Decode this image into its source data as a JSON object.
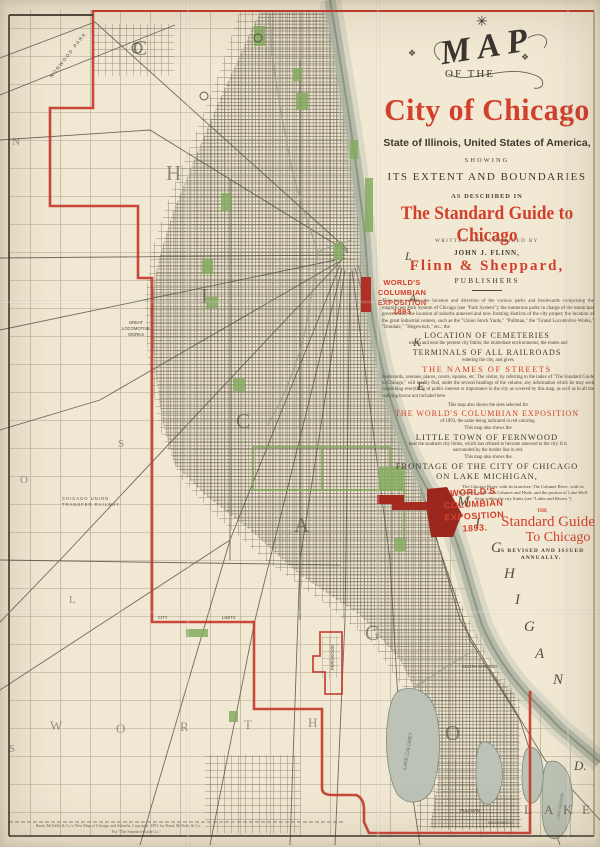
{
  "colors": {
    "paper": "#f1e8d3",
    "boundary_red": "#c5392b",
    "title_red": "#d2402c",
    "expo_red": "#b03026",
    "expo_dark_red": "#9b281f",
    "park_green": "#85ab60",
    "lake_shade": "#b2b9a8",
    "ink": "#433d31"
  },
  "title_block": {
    "star": "✳",
    "ornament_left": "❖",
    "ornament_right": "❖",
    "map_word": "MAP",
    "of_the": "OF THE",
    "city_title": "City of Chicago",
    "state_line": "State of Illinois, United States of America,",
    "showing": "SHOWING",
    "extent": "ITS EXTENT AND BOUNDARIES",
    "as_described": "AS DESCRIBED IN",
    "guide_title": "The Standard Guide to Chicago",
    "written_by": "WRITTEN AND COMPILED BY",
    "author": "JOHN J. FLINN,",
    "publisher": "Flinn & Sheppard,",
    "publishers_label": "PUBLISHERS",
    "para_intro": "This map exhibits the location and direction of the various parks and boulevards comprising the magnificent Park System of Chicago (see \"Park System\"); the numerous parks in charge of the municipal government; the location of suburbs annexed and now forming districts of the city proper; the location of the great industrial centers, such as the \"Union Stock Yards,\" \"Pullman,\" the \"Grand Locomotive Works,\" \"Irondale,\" \"Hegewisch,\" etc.; the",
    "cemeteries": "LOCATION OF CEMETERIES",
    "para_cemeteries": "within and near the present city limits; the immediate environments; the routes and",
    "terminals": "TERMINALS OF ALL RAILROADS",
    "para_terminals": "entering the city, and gives",
    "streets": "THE NAMES OF STREETS",
    "para_streets": "boulevards, avenues, places, courts, squares, etc.  The visitor, by referring to the index of \"The Standard Guide to Chicago,\" will readily find, under the several headings of the volume, any information which he may seek concerning everything of public interest or importance in the city as covered by this map, as well as in all the outlying towns not included here.",
    "para_sites": "This map also shows the sites selected for",
    "expo_heading": "THE WORLD'S COLUMBIAN EXPOSITION",
    "para_expo": "of 1893, the same being indicated in red coloring.",
    "also_shows_1": "This map also shows the",
    "fernwood": "LITTLE TOWN OF FERNWOOD",
    "para_fernwood": "near the southern city limits, which has refused to become annexed to the city.  It is surrounded by the border line in red.",
    "also_shows_2": "This map also shows the",
    "frontage_1": "FRONTAGE OF THE CITY OF CHICAGO",
    "frontage_2": "ON LAKE MICHIGAN,",
    "para_frontage": "The Chicago River, with its branches; The Calumet River, with its branches, and Lakes Calumet and Hyde, and the portion of Lake Wolf lying within the city limits (see \"Lakes and Rivers.\")",
    "the_word": "THE",
    "standard_guide_1": "Standard Guide",
    "standard_guide_2": "To Chicago",
    "annual_1": "IS REVISED AND ISSUED",
    "annual_2": "ANNUALLY."
  },
  "map_labels": {
    "expo_downtown": "WORLD'S\nCOLUMBIAN\nEXPOSITION\n1893",
    "expo_south": "WORLD'S\nCOLUMBIAN\nEXPOSITION\n1893.",
    "norwood_park": "NORWOOD PARK",
    "locomotive_works": "GREAT\nLOCOMOTIVE\nWORKS",
    "transfer_railway": "CHICAGO UNION\nTRANSFER RAILWAY",
    "city_limits_1": "CITY",
    "city_limits_2": "LIMITS",
    "pullman": "PULLMAN",
    "hegewisch": "HEGEWISCH",
    "south_chicago": "SOUTH CHICAGO",
    "fernwood_vertical": "FERNWOOD",
    "lake_calumet": "LAKE CALUMET",
    "lake_george": "LAKE GEORGE"
  },
  "letters": {
    "chicago": [
      "C",
      "H",
      "I",
      "C",
      "A",
      "G",
      "O"
    ],
    "worth": [
      "W",
      "O",
      "R",
      "T",
      "H"
    ],
    "lake_vertical": [
      "L",
      "A",
      "K",
      "E"
    ],
    "michigan": [
      "M",
      "I",
      "C",
      "H",
      "I",
      "G",
      "A",
      "N"
    ],
    "lake_big": [
      "L",
      "A",
      "K",
      "E"
    ],
    "stray_n": "N",
    "stray_s1": "S",
    "stray_o": "O",
    "stray_l": "L",
    "stray_s2": "S",
    "ind": "D."
  },
  "imprint": {
    "line1": "Rand, McNally & Co.'s New Map of Chicago and Suburbs.  Copyright, 1891, by Rand, McNally & Co.",
    "line2": "For \"The Standard Guide Co.\""
  }
}
